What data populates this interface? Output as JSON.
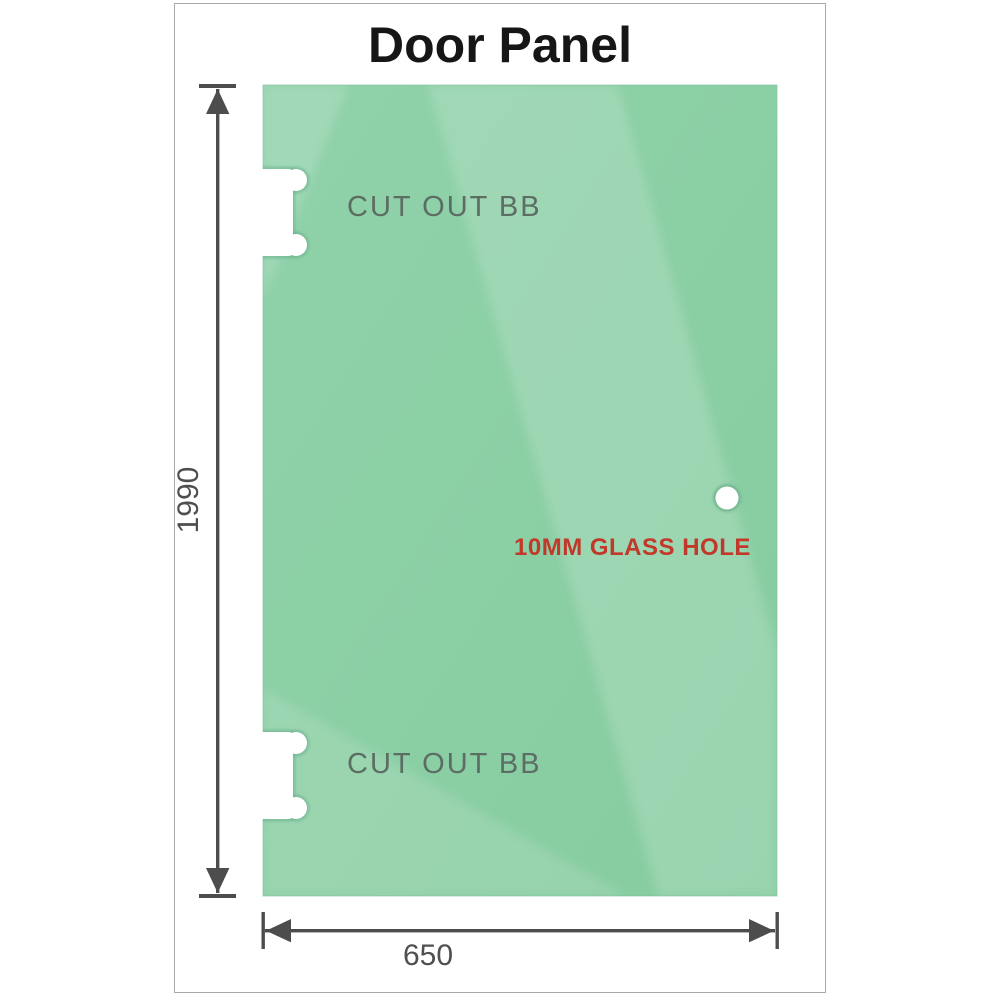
{
  "title": "Door Panel",
  "panel": {
    "top_cutout_label": "CUT OUT BB",
    "bottom_cutout_label": "CUT OUT BB",
    "hole_label": "10MM GLASS HOLE"
  },
  "dimensions": {
    "height": "1990",
    "width": "650"
  },
  "colors": {
    "glass_green": "#8ccfa6",
    "glass_sheen": "#ffffff",
    "hole_label_red": "#c0392b",
    "dimension_gray": "#4d4d4d",
    "cutout_label_gray": "#5c6e63",
    "border_gray": "#a9a9a9"
  }
}
